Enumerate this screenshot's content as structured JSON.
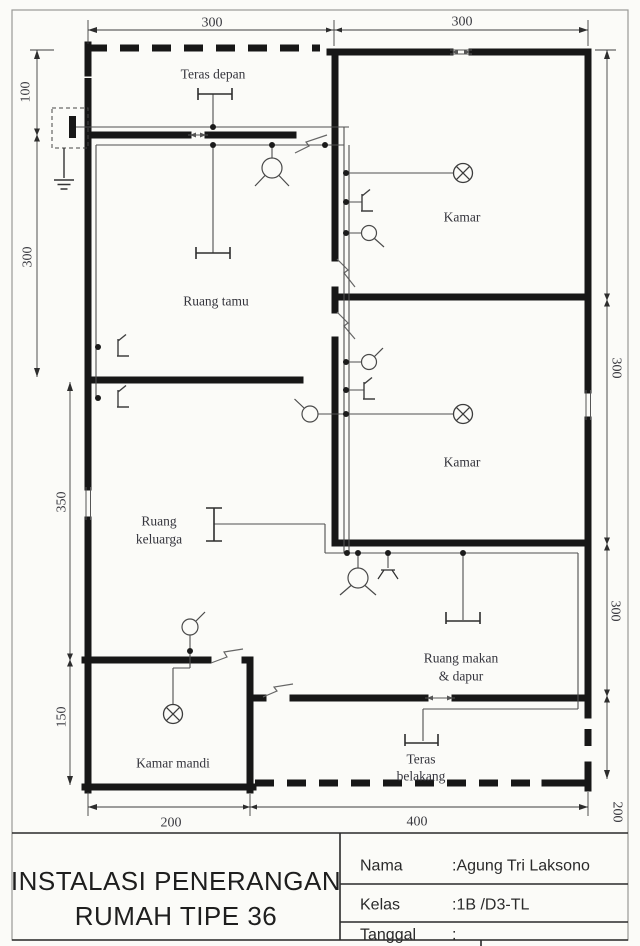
{
  "colors": {
    "wall": "#171717",
    "wire": "#4f4f4f",
    "dimension_line": "#3e3e3e",
    "label_text": "#35353d",
    "title_text": "#1e1e1e",
    "paper": "#fbfbf8"
  },
  "plan": {
    "rooms": {
      "teras_depan": "Teras depan",
      "kamar_1": "Kamar",
      "ruang_tamu": "Ruang tamu",
      "kamar_2": "Kamar",
      "ruang_keluarga_line1": "Ruang",
      "ruang_keluarga_line2": "keluarga",
      "ruang_makan_line1": "Ruang makan",
      "ruang_makan_line2": "& dapur",
      "kamar_mandi": "Kamar mandi",
      "teras_belakang_line1": "Teras",
      "teras_belakang_line2": "belakang"
    },
    "dimensions": {
      "top_left": "300",
      "top_right": "300",
      "left_teras": "100",
      "left_ruang_tamu": "300",
      "left_ruang_keluarga": "350",
      "left_kamar_mandi": "150",
      "right_kamar_2": "300",
      "right_ruang_makan": "300",
      "right_teras_belakang": "200",
      "bottom_kamar_mandi": "200",
      "bottom_teras_belakang": "400"
    }
  },
  "title_block": {
    "title_line1": "INSTALASI PENERANGAN",
    "title_line2": "RUMAH TIPE 36",
    "fields": [
      {
        "label": "Nama",
        "value": ":Agung Tri Laksono"
      },
      {
        "label": "Kelas",
        "value": ":1B /D3-TL"
      },
      {
        "label": "Tanggal",
        "value": ":"
      }
    ]
  }
}
